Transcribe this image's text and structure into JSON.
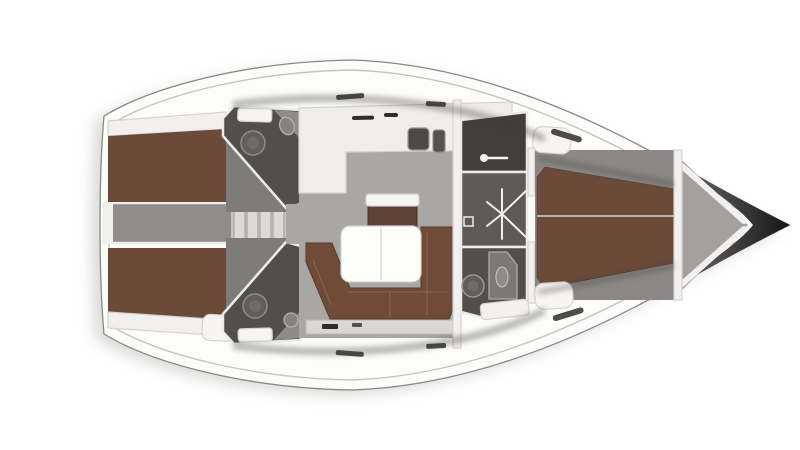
{
  "diagram": {
    "kind": "sailing-yacht-interior-floorplan-top-view",
    "rooms": [
      {
        "id": "aft-cabin-port"
      },
      {
        "id": "aft-cabin-starboard"
      },
      {
        "id": "aft-head-port"
      },
      {
        "id": "aft-head-starboard"
      },
      {
        "id": "companionway-corridor"
      },
      {
        "id": "galley"
      },
      {
        "id": "salon"
      },
      {
        "id": "wardrobe"
      },
      {
        "id": "forward-passage"
      },
      {
        "id": "forward-head"
      },
      {
        "id": "forward-cabin"
      },
      {
        "id": "anchor-locker-bow"
      }
    ]
  },
  "colors": {
    "page_bg": "#ffffff",
    "hull_white": "#fcfcfb",
    "hull_outline": "#8a8886",
    "deck_line": "#c6c4c2",
    "shadow": "#bfbdbb",
    "berth_brown": "#6b4a39",
    "sofa_brown": "#6f4b38",
    "sideboard_brown": "#5e4233",
    "salon_floor": "#a9a7a5",
    "cabin_floor": "#7e7c7a",
    "fwd_floor": "#8b8987",
    "corridor_gray": "#8f8d8b",
    "step_well": "#c7c5c3",
    "step_gray": "#dcdad8",
    "head_dark": "#514f4c",
    "passage_dark": "#5c5a58",
    "wardrobe_dark": "#413f3d",
    "fixture_gray": "#85837f",
    "fixture_light": "#8e8c89",
    "toilet_gray": "#605e5b",
    "toilet_inner": "#6e6c69",
    "shower_gray": "#7b7977",
    "counter_white": "#efedeb",
    "counter_tri": "#8e8c89",
    "furniture_white": "#f6f5f3",
    "table_white": "#fdfdfc",
    "shelf_white": "#f1f0ee",
    "wall_white": "#f2f1ef",
    "band_gray": "#d9d7d5",
    "sink_dark": "#4b4947",
    "stove_dark": "#555351",
    "bow_gray": "#a3a1a0",
    "bow_dark": "#141414",
    "bow_mid": "#777573",
    "tick_dark": "#2f2d2b",
    "ambient": "#3a3836"
  }
}
